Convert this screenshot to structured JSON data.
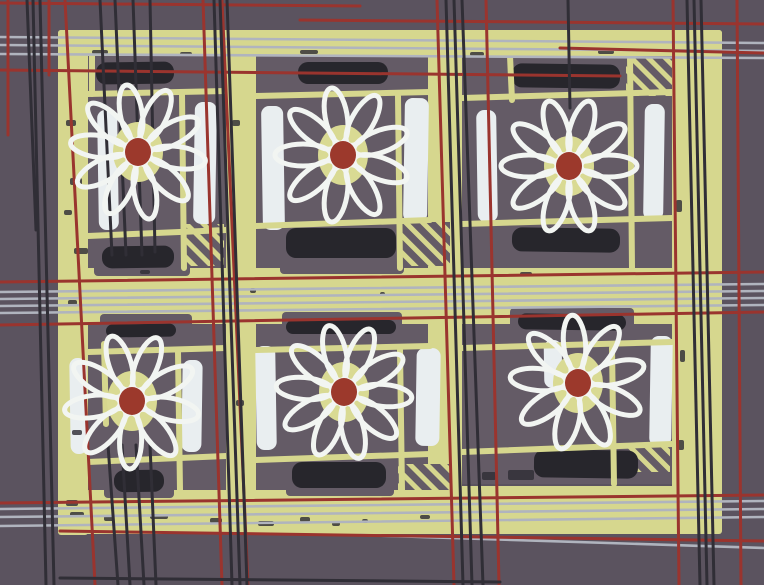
{
  "artwork": {
    "description_name": "daisy-quilt-plaid-pattern",
    "canvas": {
      "w": 764,
      "h": 585
    },
    "palette": {
      "background": "#5b535f",
      "block": "#645b66",
      "green": "#d6d78e",
      "dark_bar": "#27262c",
      "white_bar": "#e9eef0",
      "petal": "#f2f5f2",
      "flower_disc": "#d9da93",
      "flower_center": "#9c392c",
      "red_line": "#9a342e",
      "gray_line": "#b0b4be",
      "dark_line": "#302e36"
    },
    "bands": [
      {
        "name": "left-border",
        "x": 58,
        "y": 30,
        "w": 30,
        "h": 505
      },
      {
        "name": "right-border",
        "x": 672,
        "y": 30,
        "w": 50,
        "h": 492
      },
      {
        "name": "top-band",
        "x": 58,
        "y": 30,
        "w": 664,
        "h": 26
      },
      {
        "name": "middle-band",
        "x": 58,
        "y": 268,
        "w": 664,
        "h": 56
      },
      {
        "name": "bottom-band",
        "x": 58,
        "y": 486,
        "w": 664,
        "h": 48
      },
      {
        "name": "sash-1",
        "x": 226,
        "y": 30,
        "w": 30,
        "h": 504
      },
      {
        "name": "sash-2",
        "x": 428,
        "y": 30,
        "w": 34,
        "h": 504
      }
    ],
    "blocks": [
      {
        "x": 88,
        "y": 56,
        "w": 138,
        "h": 212
      },
      {
        "x": 256,
        "y": 56,
        "w": 172,
        "h": 212
      },
      {
        "x": 462,
        "y": 56,
        "w": 210,
        "h": 212
      },
      {
        "x": 88,
        "y": 324,
        "w": 138,
        "h": 166
      },
      {
        "x": 256,
        "y": 324,
        "w": 172,
        "h": 166
      },
      {
        "x": 462,
        "y": 324,
        "w": 210,
        "h": 160
      }
    ],
    "patches": [
      {
        "x": 94,
        "y": 240,
        "w": 96,
        "h": 36
      },
      {
        "x": 280,
        "y": 222,
        "w": 124,
        "h": 52
      },
      {
        "x": 506,
        "y": 222,
        "w": 126,
        "h": 46
      },
      {
        "x": 100,
        "y": 314,
        "w": 92,
        "h": 14
      },
      {
        "x": 282,
        "y": 312,
        "w": 120,
        "h": 16
      },
      {
        "x": 510,
        "y": 308,
        "w": 124,
        "h": 20
      },
      {
        "x": 104,
        "y": 468,
        "w": 70,
        "h": 30
      },
      {
        "x": 286,
        "y": 458,
        "w": 108,
        "h": 38
      },
      {
        "x": 528,
        "y": 446,
        "w": 116,
        "h": 38
      }
    ],
    "dark_bars": [
      {
        "x": 96,
        "y": 62,
        "w": 78,
        "h": 22
      },
      {
        "x": 298,
        "y": 62,
        "w": 90,
        "h": 22
      },
      {
        "x": 512,
        "y": 64,
        "w": 108,
        "h": 24
      },
      {
        "x": 102,
        "y": 246,
        "w": 72,
        "h": 22
      },
      {
        "x": 286,
        "y": 228,
        "w": 110,
        "h": 30
      },
      {
        "x": 512,
        "y": 228,
        "w": 108,
        "h": 24
      },
      {
        "x": 106,
        "y": 324,
        "w": 70,
        "h": 13
      },
      {
        "x": 286,
        "y": 320,
        "w": 110,
        "h": 14
      },
      {
        "x": 518,
        "y": 314,
        "w": 108,
        "h": 16
      },
      {
        "x": 114,
        "y": 470,
        "w": 50,
        "h": 22
      },
      {
        "x": 292,
        "y": 462,
        "w": 94,
        "h": 26
      },
      {
        "x": 534,
        "y": 450,
        "w": 104,
        "h": 28
      }
    ],
    "white_bars": [
      {
        "x": 98,
        "y": 110,
        "w": 20,
        "h": 120
      },
      {
        "x": 194,
        "y": 102,
        "w": 22,
        "h": 122
      },
      {
        "x": 262,
        "y": 106,
        "w": 22,
        "h": 124
      },
      {
        "x": 404,
        "y": 98,
        "w": 24,
        "h": 124
      },
      {
        "x": 477,
        "y": 110,
        "w": 20,
        "h": 112
      },
      {
        "x": 644,
        "y": 104,
        "w": 20,
        "h": 116
      },
      {
        "x": 70,
        "y": 358,
        "w": 17,
        "h": 96
      },
      {
        "x": 182,
        "y": 360,
        "w": 20,
        "h": 92
      },
      {
        "x": 256,
        "y": 346,
        "w": 20,
        "h": 104
      },
      {
        "x": 416,
        "y": 348,
        "w": 24,
        "h": 98
      },
      {
        "x": 544,
        "y": 340,
        "w": 18,
        "h": 48
      },
      {
        "x": 650,
        "y": 336,
        "w": 22,
        "h": 110
      }
    ],
    "hatches": [
      {
        "x": 184,
        "y": 224,
        "w": 40,
        "h": 42
      },
      {
        "x": 398,
        "y": 222,
        "w": 52,
        "h": 44
      },
      {
        "x": 626,
        "y": 58,
        "w": 46,
        "h": 38
      },
      {
        "x": 398,
        "y": 464,
        "w": 52,
        "h": 26
      },
      {
        "x": 628,
        "y": 444,
        "w": 42,
        "h": 28
      }
    ],
    "green_lines": [
      [
        88,
        94,
        226,
        91
      ],
      [
        88,
        236,
        226,
        230
      ],
      [
        182,
        94,
        184,
        268
      ],
      [
        92,
        56,
        92,
        94
      ],
      [
        256,
        96,
        430,
        92
      ],
      [
        256,
        226,
        430,
        220
      ],
      [
        398,
        96,
        400,
        268
      ],
      [
        462,
        98,
        672,
        92
      ],
      [
        462,
        224,
        672,
        218
      ],
      [
        630,
        56,
        632,
        268
      ],
      [
        510,
        56,
        512,
        100
      ],
      [
        88,
        352,
        226,
        348
      ],
      [
        88,
        462,
        226,
        456
      ],
      [
        104,
        344,
        106,
        424
      ],
      [
        178,
        352,
        180,
        490
      ],
      [
        256,
        350,
        430,
        346
      ],
      [
        256,
        460,
        430,
        454
      ],
      [
        400,
        350,
        402,
        490
      ],
      [
        462,
        348,
        672,
        342
      ],
      [
        462,
        452,
        672,
        444
      ],
      [
        612,
        348,
        614,
        484
      ]
    ],
    "flower_style": {
      "disc_rx": 25,
      "disc_ry": 30,
      "center_rx": 13,
      "center_ry": 14,
      "petal_off": 40,
      "petal_len": 28,
      "petal_w": 11,
      "petal_stroke": 5
    },
    "flowers": [
      {
        "cx": 138,
        "cy": 152,
        "petals": 10,
        "a0": 8
      },
      {
        "cx": 343,
        "cy": 155,
        "petals": 9,
        "a0": 20
      },
      {
        "cx": 569,
        "cy": 166,
        "petals": 10,
        "a0": 0
      },
      {
        "cx": 132,
        "cy": 401,
        "petals": 9,
        "a0": 12
      },
      {
        "cx": 344,
        "cy": 392,
        "petals": 10,
        "a0": 5
      },
      {
        "cx": 578,
        "cy": 383,
        "petals": 9,
        "a0": 25
      }
    ],
    "plaid": {
      "gray": {
        "width": 2.6,
        "lines": [
          [
            0,
            37,
            764,
            43
          ],
          [
            0,
            45,
            764,
            51
          ],
          [
            0,
            54,
            764,
            58
          ],
          [
            0,
            292,
            764,
            284
          ],
          [
            0,
            299,
            764,
            291
          ],
          [
            0,
            306,
            764,
            298
          ],
          [
            0,
            313,
            764,
            305
          ],
          [
            0,
            509,
            764,
            501
          ],
          [
            0,
            517,
            764,
            509
          ],
          [
            0,
            526,
            764,
            517
          ],
          [
            360,
            535,
            764,
            548
          ]
        ]
      },
      "red": {
        "width": 3,
        "h_lines": [
          [
            0,
            3,
            360,
            6
          ],
          [
            300,
            20,
            764,
            24
          ],
          [
            560,
            48,
            764,
            53
          ],
          [
            0,
            70,
            620,
            76
          ],
          [
            0,
            282,
            764,
            272
          ],
          [
            0,
            325,
            764,
            312
          ],
          [
            0,
            503,
            764,
            495
          ],
          [
            60,
            531,
            764,
            541
          ]
        ],
        "v_lines": [
          [
            8,
            0,
            8,
            135
          ],
          [
            49,
            0,
            49,
            75
          ],
          [
            65,
            0,
            95,
            585
          ],
          [
            203,
            0,
            222,
            585
          ],
          [
            222,
            0,
            248,
            585
          ],
          [
            437,
            0,
            454,
            585
          ],
          [
            486,
            0,
            499,
            585
          ],
          [
            673,
            0,
            679,
            585
          ],
          [
            737,
            0,
            741,
            585
          ]
        ]
      },
      "dark": {
        "width": 3,
        "v_lines": [
          [
            33,
            0,
            46,
            585
          ],
          [
            40,
            0,
            54,
            585
          ],
          [
            27,
            0,
            36,
            230
          ],
          [
            100,
            0,
            112,
            255
          ],
          [
            115,
            0,
            126,
            255
          ],
          [
            133,
            0,
            142,
            255
          ],
          [
            150,
            0,
            155,
            252
          ],
          [
            108,
            445,
            118,
            585
          ],
          [
            122,
            445,
            130,
            585
          ],
          [
            136,
            445,
            144,
            585
          ],
          [
            150,
            445,
            156,
            585
          ],
          [
            214,
            0,
            232,
            585
          ],
          [
            220,
            0,
            240,
            585
          ],
          [
            227,
            0,
            247,
            585
          ],
          [
            446,
            0,
            463,
            585
          ],
          [
            454,
            0,
            472,
            585
          ],
          [
            462,
            0,
            483,
            585
          ],
          [
            568,
            0,
            570,
            108
          ],
          [
            687,
            0,
            700,
            585
          ],
          [
            694,
            0,
            707,
            585
          ],
          [
            701,
            0,
            714,
            585
          ]
        ],
        "h_lines": [
          [
            60,
            578,
            500,
            582
          ]
        ]
      }
    },
    "speckles": [
      [
        66,
        120,
        10,
        6
      ],
      [
        70,
        178,
        12,
        7
      ],
      [
        64,
        210,
        8,
        5
      ],
      [
        74,
        248,
        14,
        6
      ],
      [
        68,
        300,
        9,
        5
      ],
      [
        72,
        430,
        10,
        5
      ],
      [
        66,
        500,
        12,
        6
      ],
      [
        92,
        50,
        16,
        4
      ],
      [
        180,
        52,
        12,
        4
      ],
      [
        300,
        50,
        18,
        4
      ],
      [
        470,
        52,
        14,
        4
      ],
      [
        598,
        50,
        16,
        4
      ],
      [
        140,
        270,
        10,
        4
      ],
      [
        250,
        288,
        6,
        5
      ],
      [
        380,
        292,
        5,
        4
      ],
      [
        520,
        272,
        12,
        4
      ],
      [
        70,
        512,
        14,
        5
      ],
      [
        104,
        516,
        10,
        5
      ],
      [
        150,
        514,
        18,
        5
      ],
      [
        210,
        518,
        12,
        5
      ],
      [
        258,
        521,
        16,
        5
      ],
      [
        300,
        517,
        10,
        5
      ],
      [
        332,
        522,
        8,
        4
      ],
      [
        362,
        519,
        6,
        4
      ],
      [
        420,
        515,
        10,
        4
      ],
      [
        676,
        200,
        6,
        12
      ],
      [
        680,
        350,
        5,
        12
      ],
      [
        678,
        440,
        6,
        10
      ],
      [
        232,
        120,
        8,
        6
      ],
      [
        236,
        400,
        8,
        6
      ],
      [
        508,
        470,
        26,
        10
      ],
      [
        482,
        472,
        14,
        8
      ]
    ]
  }
}
